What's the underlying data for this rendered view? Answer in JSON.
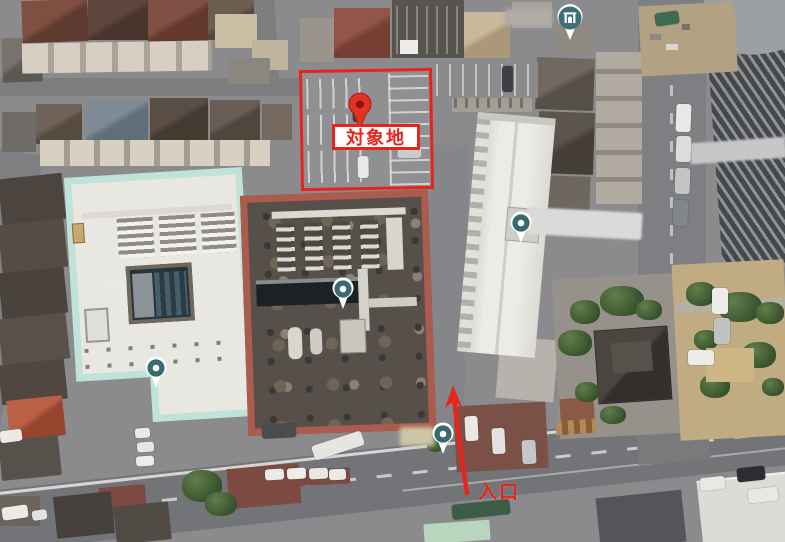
{
  "map": {
    "annotations": {
      "site_label": "対象地",
      "entrance_label": "入口",
      "highlight_color": "#e8231c"
    },
    "markers": {
      "teal_color": "#3a6a70",
      "target_pin": {
        "x": 360,
        "y": 107,
        "icon": "red-map-pin-icon"
      },
      "poi_pins": [
        {
          "x": 156,
          "y": 369
        },
        {
          "x": 343,
          "y": 290
        },
        {
          "x": 521,
          "y": 224
        },
        {
          "x": 443,
          "y": 435
        }
      ],
      "icon_marker": {
        "x": 570,
        "y": 19,
        "icon": "shrine-icon"
      }
    },
    "site_boundary": {
      "x": 300,
      "y": 69,
      "width": 133,
      "height": 121
    }
  }
}
